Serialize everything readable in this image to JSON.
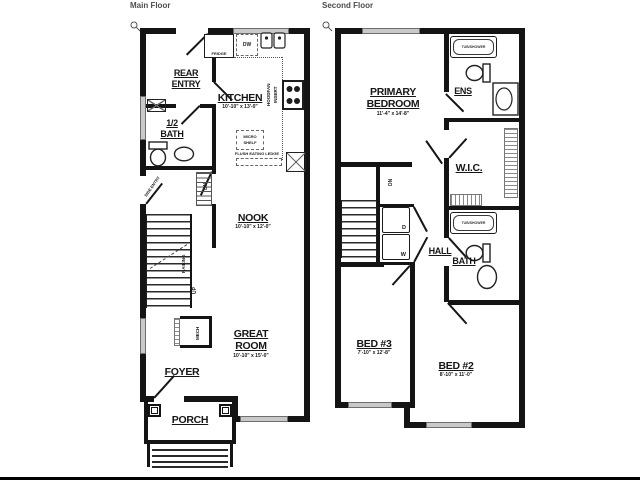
{
  "page": {
    "bg": "#ffffff",
    "wall_color": "#141414",
    "window_color": "#c9c9c9"
  },
  "main_floor": {
    "title": "Main Floor",
    "rooms": {
      "rear_entry": {
        "line1": "REAR",
        "line2": "ENTRY"
      },
      "kitchen": {
        "name": "KITCHEN",
        "dims": "10'-10\" x 13'-0\""
      },
      "half_bath": {
        "line1": "1/2",
        "line2": "BATH"
      },
      "nook": {
        "name": "NOOK",
        "dims": "10'-10\" x 12'-0\""
      },
      "great_room": {
        "line1": "GREAT",
        "line2": "ROOM",
        "dims": "10'-10\" x 15'-0\""
      },
      "foyer": {
        "name": "FOYER"
      },
      "porch": {
        "name": "PORCH"
      }
    },
    "annotations": {
      "fridge": "FRIDGE",
      "dw": "DW",
      "hoodfan_line1": "HOODFAN",
      "hoodfan_line2": "INSERT",
      "micro_line1": "MICRO",
      "micro_line2": "SHELF",
      "flush_ledge": "FLUSH EATING LEDGE",
      "side_entry": "SIDE ENTRY",
      "dn": "DN",
      "up": "UP",
      "railing": "RAILING",
      "mech": "MECH"
    }
  },
  "second_floor": {
    "title": "Second Floor",
    "rooms": {
      "primary_bedroom": {
        "line1": "PRIMARY",
        "line2": "BEDROOM",
        "dims": "11'-4\" x 14'-8\""
      },
      "ensuite": {
        "name": "ENS"
      },
      "wic": {
        "name": "W.I.C."
      },
      "hall": {
        "name": "HALL"
      },
      "bath": {
        "name": "BATH"
      },
      "bed3": {
        "name": "BED #3",
        "dims": "7'-10\" x 12'-8\""
      },
      "bed2": {
        "name": "BED #2",
        "dims": "8'-10\" x 11'-0\""
      }
    },
    "annotations": {
      "tub_shower_ens": "TUB/SHOWER",
      "tub_shower_bath": "TUB/SHOWER",
      "dryer": "D",
      "washer": "W",
      "dn": "DN"
    }
  }
}
